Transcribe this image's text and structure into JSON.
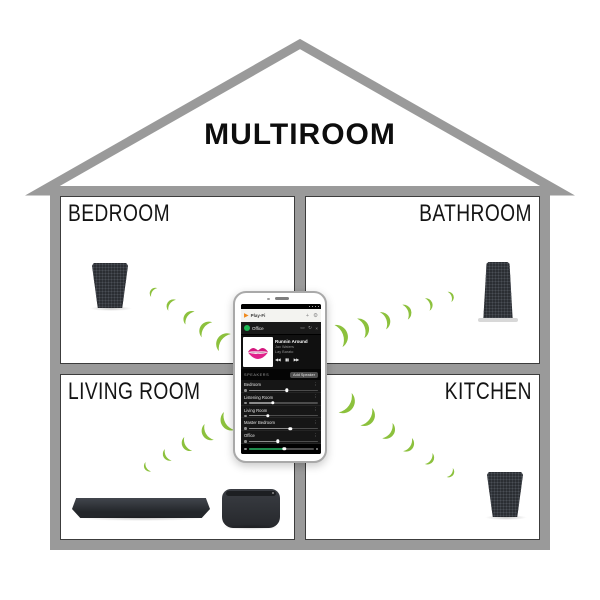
{
  "title": "MULTIROOM",
  "rooms": [
    {
      "id": "bedroom",
      "label": "BEDROOM"
    },
    {
      "id": "bathroom",
      "label": "BATHROOM"
    },
    {
      "id": "living-room",
      "label": "LIVING ROOM"
    },
    {
      "id": "kitchen",
      "label": "KITCHEN"
    }
  ],
  "colors": {
    "wall_gray": "#9a9a9a",
    "signal_green": "#8cc13d",
    "spotify_green": "#1db954",
    "playfi_orange": "#f08a1d"
  },
  "phone": {
    "app_bar": {
      "app_name": "Play-Fi",
      "plus_label": "+",
      "gear_icon": "⚙"
    },
    "source_row": {
      "zone": "Office",
      "cast_icon": "▭",
      "refresh_icon": "↻",
      "close_icon": "×"
    },
    "now_playing": {
      "title": "Runnin Around",
      "artist": "Jax Waters",
      "album": "Lay Barato",
      "prev_icon": "◀◀",
      "pause_icon": "▮▮",
      "next_icon": "▶▶"
    },
    "speakers_header": {
      "label": "SPEAKERS",
      "add_button": "Add Speaker"
    },
    "menu_icon": "⋮",
    "speakers": [
      {
        "name": "Bedroom",
        "volume": 55
      },
      {
        "name": "Listening Room",
        "volume": 35
      },
      {
        "name": "Living Room",
        "volume": 28
      },
      {
        "name": "Master Bedroom",
        "volume": 60
      },
      {
        "name": "Office",
        "volume": 42
      }
    ],
    "master_volume": 55
  }
}
